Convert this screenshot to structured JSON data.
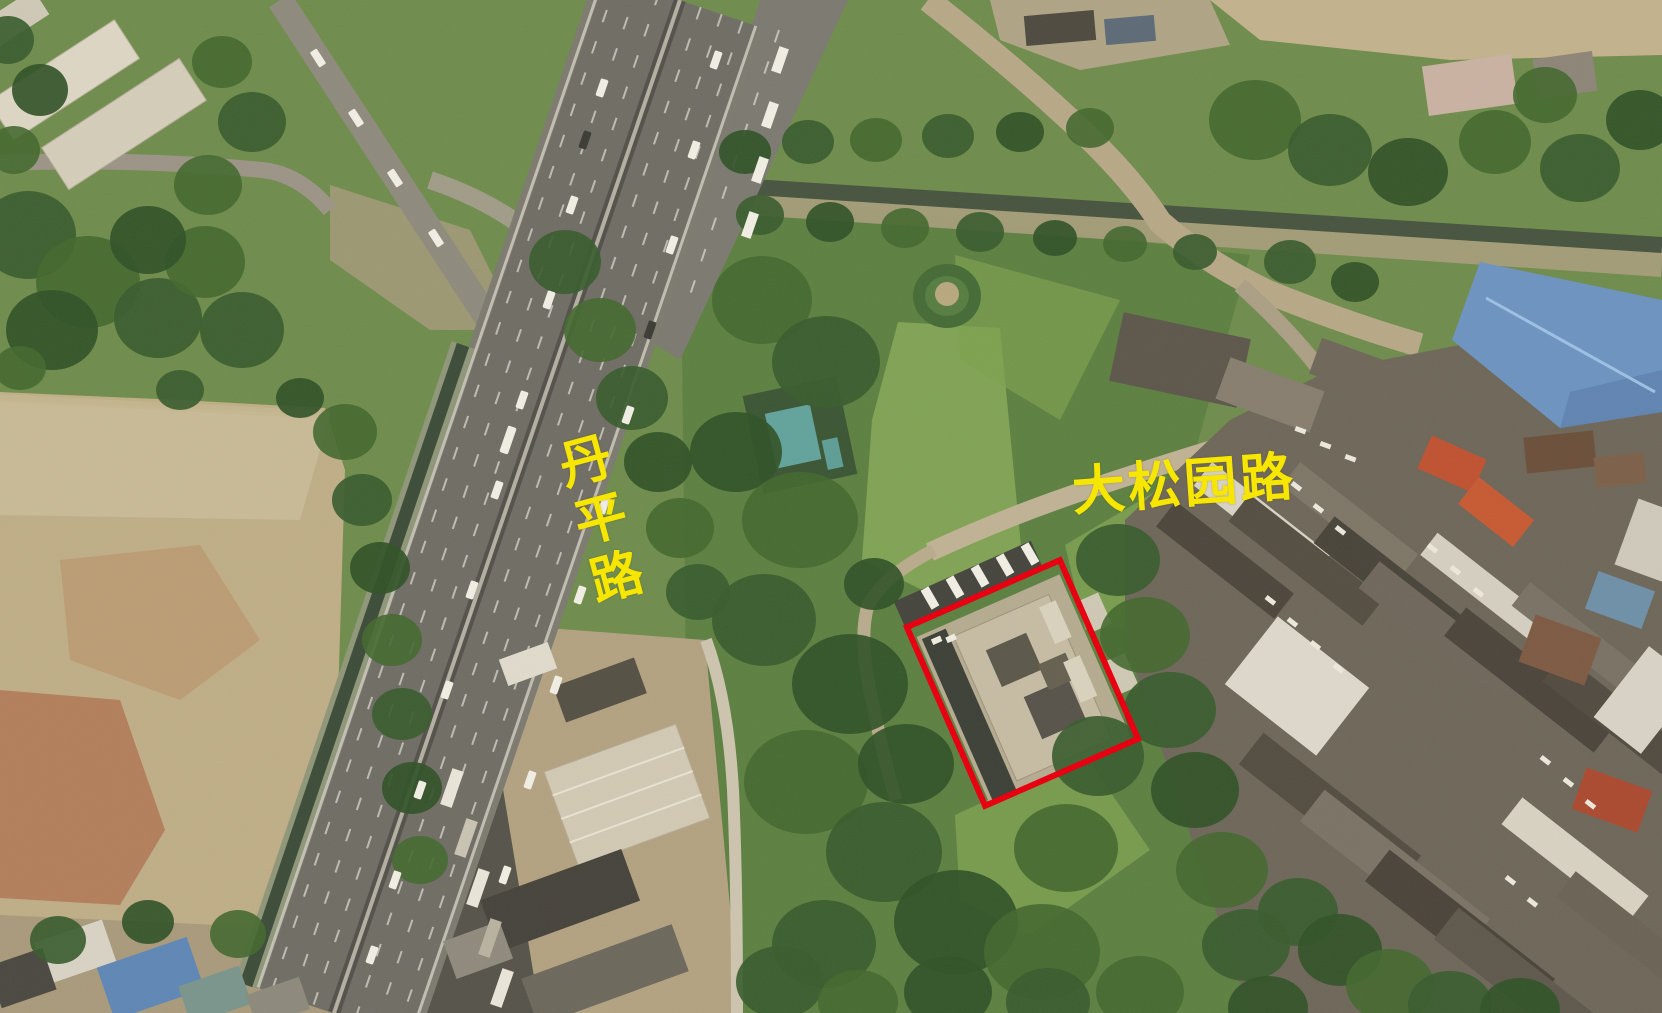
{
  "image": {
    "kind": "satellite-aerial-photograph",
    "road_labels": [
      {
        "id": "danping-road",
        "text": "丹平路",
        "orientation": "vertical",
        "color": "#f7e600"
      },
      {
        "id": "dasongyuan-road",
        "text": "大松园路",
        "orientation": "horizontal",
        "color": "#f7e600"
      }
    ],
    "highlight": {
      "id": "site-boundary",
      "shape": "rotated-rectangle",
      "stroke_color": "#e60012",
      "stroke_width_px": 6
    }
  }
}
